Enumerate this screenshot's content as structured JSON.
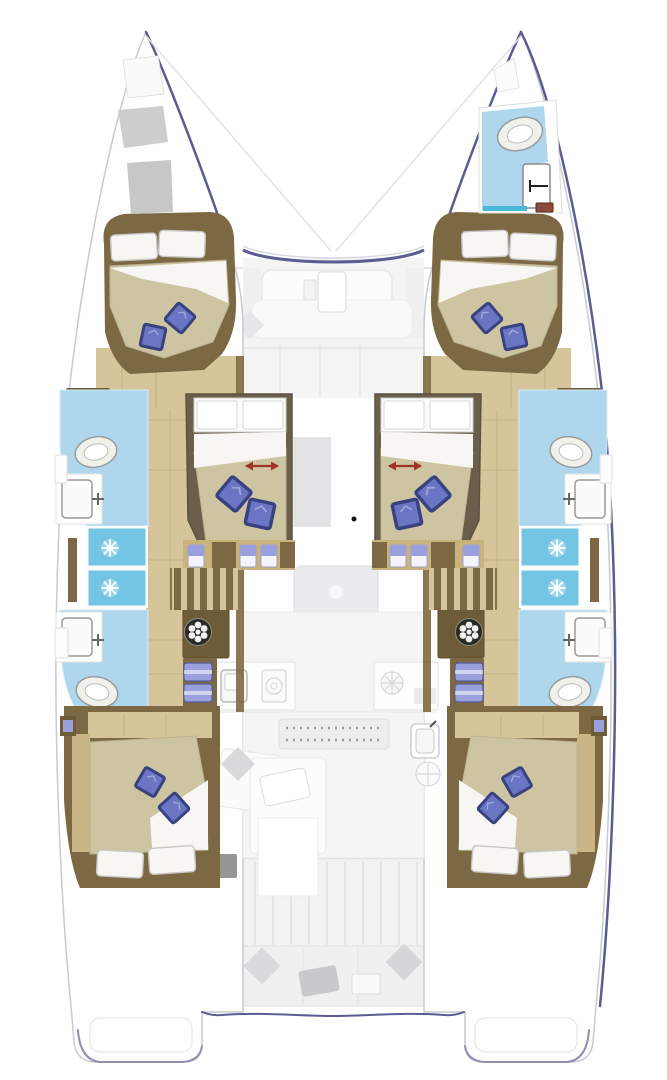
{
  "diagram": {
    "type": "yacht-floor-plan",
    "subject": "catamaran-interior-layout",
    "orientation": "bow-up",
    "counts": {
      "double_beds": 6,
      "bathrooms": 5,
      "showers": 2,
      "toilets": 5,
      "sinks": 5
    },
    "rooms": [
      {
        "name": "forward-cockpit"
      },
      {
        "name": "bow-bathroom-starboard"
      },
      {
        "name": "port-forward-cabin"
      },
      {
        "name": "starboard-forward-cabin"
      },
      {
        "name": "port-center-cabin"
      },
      {
        "name": "starboard-center-cabin"
      },
      {
        "name": "port-forward-bathroom"
      },
      {
        "name": "starboard-forward-bathroom"
      },
      {
        "name": "port-shower"
      },
      {
        "name": "starboard-shower"
      },
      {
        "name": "port-aft-bathroom"
      },
      {
        "name": "starboard-aft-bathroom"
      },
      {
        "name": "port-aft-cabin"
      },
      {
        "name": "starboard-aft-cabin"
      },
      {
        "name": "salon-galley"
      },
      {
        "name": "aft-cockpit"
      },
      {
        "name": "port-transom-platform"
      },
      {
        "name": "starboard-transom-platform"
      }
    ],
    "icons": [
      {
        "name": "shower-spray-icon"
      },
      {
        "name": "washer-drum-icon"
      },
      {
        "name": "toilet-icon"
      },
      {
        "name": "sink-faucet-icon"
      },
      {
        "name": "stove-burner-icon"
      },
      {
        "name": "bed-slide-arrow-icon"
      },
      {
        "name": "pillow-icon"
      },
      {
        "name": "towel-stack-icon"
      }
    ]
  },
  "colors": {
    "hull_accent": "#5c5c94",
    "hull_line": "#c9c9d2",
    "wood_dark": "#7c6843",
    "wood_cabinet": "#6e5b38",
    "wood_wall": "#80693f",
    "wood_floor": "#d6c59b",
    "wood_floor_seam": "#c4b081",
    "wood_step": "#c9b27c",
    "wood_light": "#c9b585",
    "cabin_frame": "#6a5f4b",
    "mattress": "#cdc4a2",
    "mattress_edge": "#bcb390",
    "sheet": "#f7f6f2",
    "pillow_blue": "#6a75c4",
    "pillow_blue_dark": "#39427f",
    "pillow_blue_light": "#9aa0dc",
    "bath_floor": "#aed7ed",
    "shower_tile": "#74c5e4",
    "teal_strip": "#49b8d8",
    "fixture": "#f1f1ec",
    "fixture_stroke": "#9a9a9a",
    "washer_drum": "#2b2b23",
    "arrow_red": "#a03226",
    "red_item": "#8a4b3a",
    "black_dot": "#151515"
  }
}
